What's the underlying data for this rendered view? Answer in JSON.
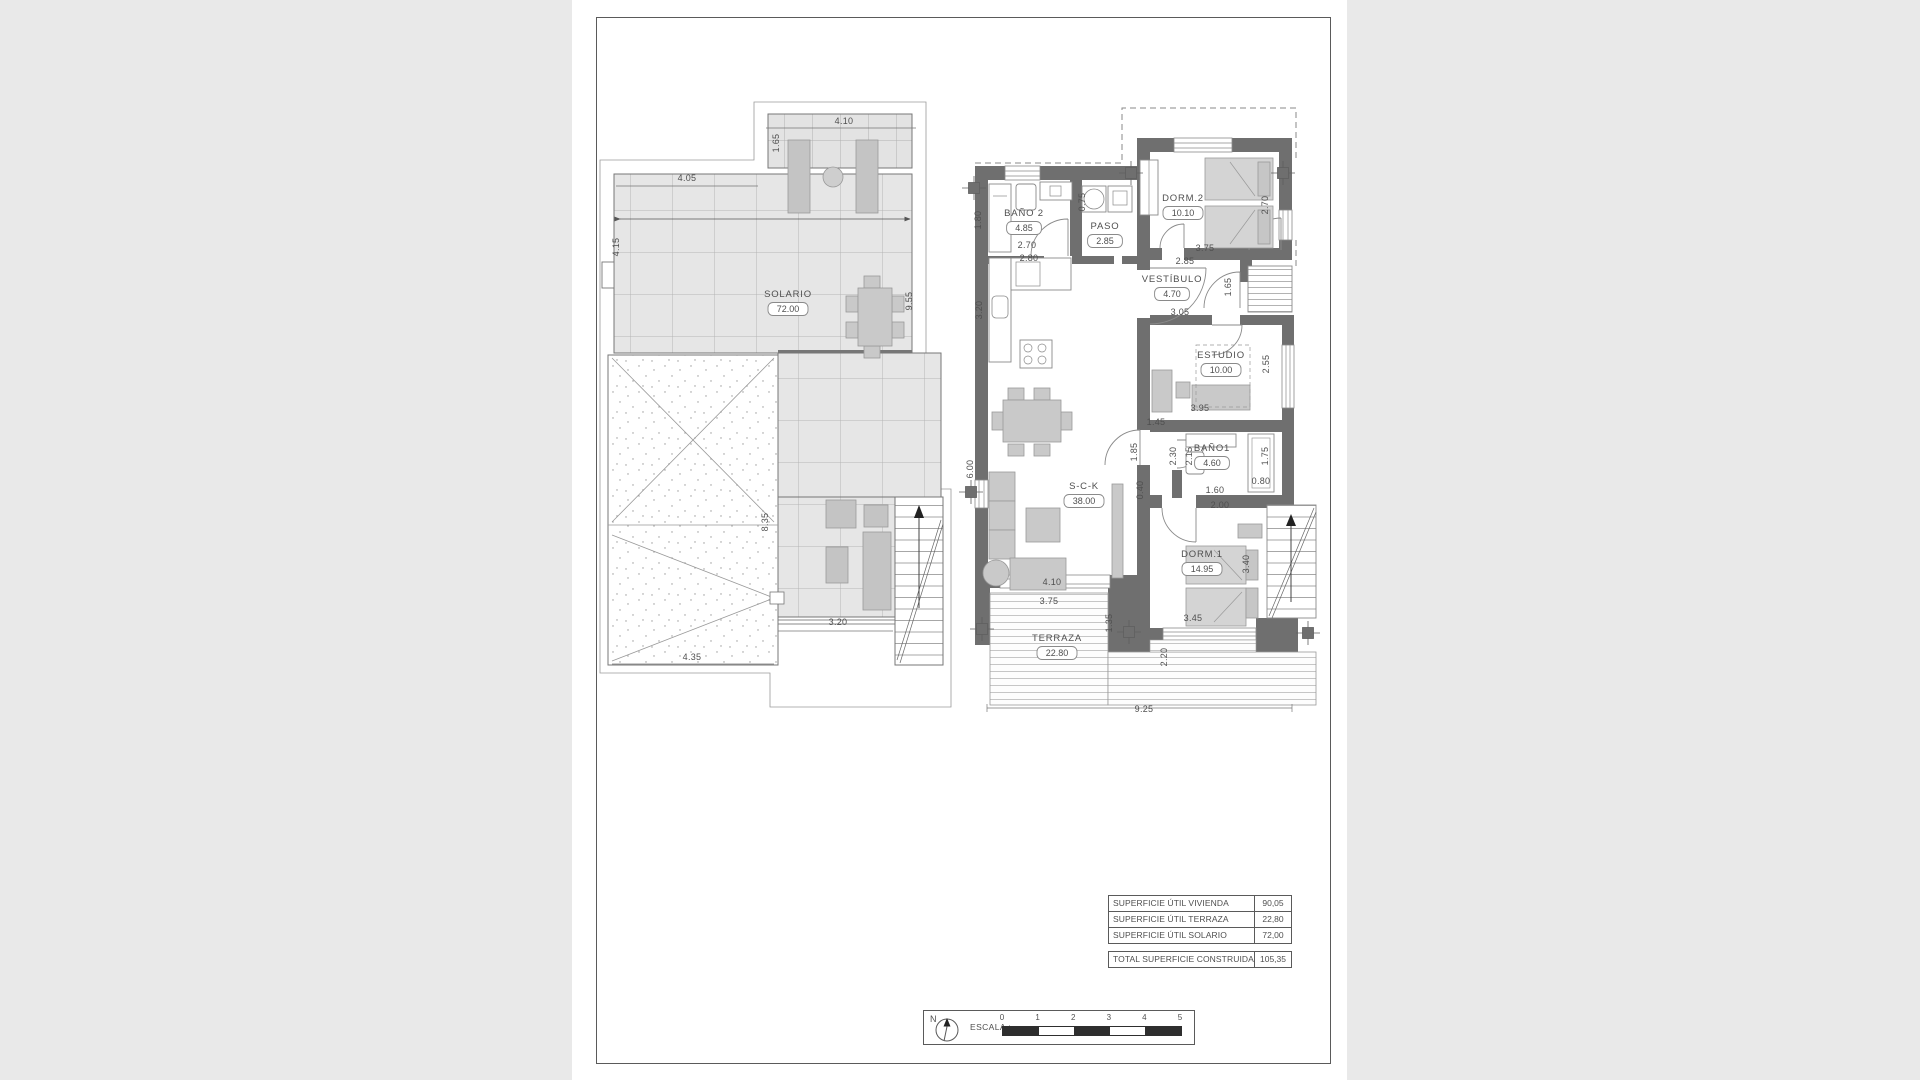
{
  "colors": {
    "background": "#e9e9e9",
    "sheet": "#ffffff",
    "wall": "#6f6f6f",
    "tile_fill": "#e6e6e6",
    "line": "#5a5a5a",
    "scale_dark": "#2e2e2e"
  },
  "rooms": [
    {
      "name": "SOLARIO",
      "area": "72.00",
      "x": 788,
      "y": 297
    },
    {
      "name": "BAÑO 2",
      "area": "4.85",
      "x": 1024,
      "y": 216
    },
    {
      "name": "PASO",
      "area": "2.85",
      "x": 1105,
      "y": 229
    },
    {
      "name": "DORM.2",
      "area": "10.10",
      "x": 1183,
      "y": 201
    },
    {
      "name": "VESTÍBULO",
      "area": "4.70",
      "x": 1172,
      "y": 282
    },
    {
      "name": "ESTUDIO",
      "area": "10.00",
      "x": 1221,
      "y": 358
    },
    {
      "name": "BAÑO1",
      "area": "4.60",
      "x": 1212,
      "y": 451
    },
    {
      "name": "DORM.1",
      "area": "14.95",
      "x": 1202,
      "y": 557
    },
    {
      "name": "S-C-K",
      "area": "38.00",
      "x": 1084,
      "y": 489
    },
    {
      "name": "TERRAZA",
      "area": "22.80",
      "x": 1057,
      "y": 641
    }
  ],
  "dimensions": [
    {
      "t": "4.10",
      "x": 844,
      "y": 124
    },
    {
      "t": "1.65",
      "x": 779,
      "y": 143,
      "r": -90
    },
    {
      "t": "4.05",
      "x": 687,
      "y": 181
    },
    {
      "t": "4.15",
      "x": 619,
      "y": 247,
      "r": -90
    },
    {
      "t": "9.55",
      "x": 912,
      "y": 301,
      "r": -90
    },
    {
      "t": "8.35",
      "x": 768,
      "y": 522,
      "r": -90
    },
    {
      "t": "3.20",
      "x": 838,
      "y": 625
    },
    {
      "t": "4.35",
      "x": 692,
      "y": 660
    },
    {
      "t": "1.80",
      "x": 981,
      "y": 220,
      "r": -90
    },
    {
      "t": "2.70",
      "x": 1027,
      "y": 248
    },
    {
      "t": "2.80",
      "x": 1029,
      "y": 261
    },
    {
      "t": "0.75",
      "x": 1085,
      "y": 202,
      "r": -90
    },
    {
      "t": "3.20",
      "x": 982,
      "y": 310,
      "r": -90
    },
    {
      "t": "2.70",
      "x": 1268,
      "y": 205,
      "r": -90
    },
    {
      "t": "3.75",
      "x": 1205,
      "y": 251
    },
    {
      "t": "2.85",
      "x": 1185,
      "y": 264
    },
    {
      "t": "1.65",
      "x": 1231,
      "y": 287,
      "r": -90
    },
    {
      "t": "3.05",
      "x": 1180,
      "y": 315
    },
    {
      "t": "2.55",
      "x": 1269,
      "y": 364,
      "r": -90
    },
    {
      "t": "3.95",
      "x": 1200,
      "y": 411
    },
    {
      "t": "1.45",
      "x": 1156,
      "y": 425
    },
    {
      "t": "1.85",
      "x": 1137,
      "y": 452,
      "r": -90
    },
    {
      "t": "2.30",
      "x": 1176,
      "y": 456,
      "r": -90
    },
    {
      "t": "2.15",
      "x": 1192,
      "y": 456,
      "r": -90
    },
    {
      "t": "1.75",
      "x": 1268,
      "y": 456,
      "r": -90
    },
    {
      "t": "0.80",
      "x": 1261,
      "y": 484
    },
    {
      "t": "1.60",
      "x": 1215,
      "y": 493
    },
    {
      "t": "2.00",
      "x": 1220,
      "y": 508
    },
    {
      "t": "0.40",
      "x": 1143,
      "y": 490,
      "r": -90
    },
    {
      "t": "3.40",
      "x": 1249,
      "y": 564,
      "r": -90
    },
    {
      "t": "6.00",
      "x": 973,
      "y": 469,
      "r": -90
    },
    {
      "t": "4.10",
      "x": 1052,
      "y": 585
    },
    {
      "t": "3.75",
      "x": 1049,
      "y": 604
    },
    {
      "t": "1.35",
      "x": 1112,
      "y": 623,
      "r": -90
    },
    {
      "t": "3.45",
      "x": 1193,
      "y": 621
    },
    {
      "t": "2.20",
      "x": 1167,
      "y": 657,
      "r": -90
    },
    {
      "t": "9.25",
      "x": 1144,
      "y": 712
    }
  ],
  "areas_table": {
    "rows": [
      {
        "label": "SUPERFICIE ÚTIL VIVIENDA",
        "value": "90,05"
      },
      {
        "label": "SUPERFICIE ÚTIL TERRAZA",
        "value": "22,80"
      },
      {
        "label": "SUPERFICIE ÚTIL SOLARIO",
        "value": "72,00"
      }
    ],
    "total": {
      "label": "TOTAL SUPERFICIE CONSTRUIDA",
      "value": "105,35"
    }
  },
  "scale_bar": {
    "label": "ESCALA :",
    "north": "N",
    "ticks": [
      "0",
      "1",
      "2",
      "3",
      "4",
      "5"
    ]
  }
}
